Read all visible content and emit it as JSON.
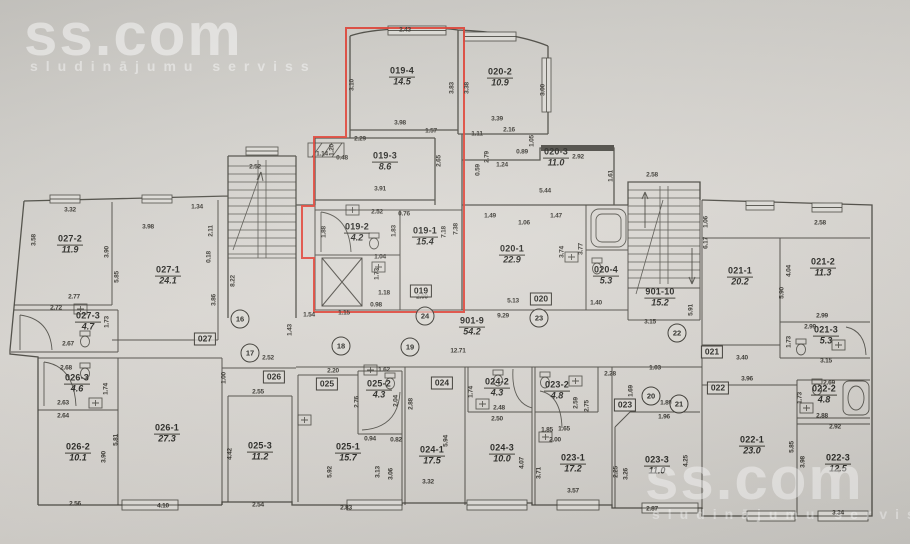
{
  "watermarks": {
    "logo": "ss.com",
    "tagline": "sludinājumu serviss"
  },
  "highlight": {
    "apartment": "019",
    "color": "#df3a2c"
  },
  "rooms": [
    {
      "name": "019-4",
      "area": "14.5",
      "x": 402,
      "y": 77
    },
    {
      "name": "020-2",
      "area": "10.9",
      "x": 500,
      "y": 78
    },
    {
      "name": "019-3",
      "area": "8.6",
      "x": 385,
      "y": 162
    },
    {
      "name": "020-3",
      "area": "11.0",
      "x": 556,
      "y": 158
    },
    {
      "name": "019-2",
      "area": "4.2",
      "x": 357,
      "y": 233
    },
    {
      "name": "019-1",
      "area": "15.4",
      "x": 425,
      "y": 237
    },
    {
      "name": "020-1",
      "area": "22.9",
      "x": 512,
      "y": 255
    },
    {
      "name": "020-4",
      "area": "5.3",
      "x": 606,
      "y": 276
    },
    {
      "name": "027-2",
      "area": "11.9",
      "x": 70,
      "y": 245
    },
    {
      "name": "027-1",
      "area": "24.1",
      "x": 168,
      "y": 276
    },
    {
      "name": "027-3",
      "area": "4.7",
      "x": 88,
      "y": 322
    },
    {
      "name": "901-10",
      "area": "15.2",
      "x": 660,
      "y": 298
    },
    {
      "name": "021-1",
      "area": "20.2",
      "x": 740,
      "y": 277
    },
    {
      "name": "021-2",
      "area": "11.3",
      "x": 823,
      "y": 268
    },
    {
      "name": "021-3",
      "area": "5.3",
      "x": 826,
      "y": 336
    },
    {
      "name": "901-9",
      "area": "54.2",
      "x": 472,
      "y": 327
    },
    {
      "name": "026-3",
      "area": "4.6",
      "x": 77,
      "y": 384
    },
    {
      "name": "026-2",
      "area": "10.1",
      "x": 78,
      "y": 453
    },
    {
      "name": "026-1",
      "area": "27.3",
      "x": 167,
      "y": 434
    },
    {
      "name": "025-3",
      "area": "11.2",
      "x": 260,
      "y": 452
    },
    {
      "name": "025-2",
      "area": "4.3",
      "x": 379,
      "y": 390
    },
    {
      "name": "025-1",
      "area": "15.7",
      "x": 348,
      "y": 453
    },
    {
      "name": "024-2",
      "area": "4.3",
      "x": 497,
      "y": 388
    },
    {
      "name": "024-1",
      "area": "17.5",
      "x": 432,
      "y": 456
    },
    {
      "name": "024-3",
      "area": "10.0",
      "x": 502,
      "y": 454
    },
    {
      "name": "023-2",
      "area": "4.8",
      "x": 557,
      "y": 391
    },
    {
      "name": "023-1",
      "area": "17.2",
      "x": 573,
      "y": 464
    },
    {
      "name": "023-3",
      "area": "11.0",
      "x": 657,
      "y": 466
    },
    {
      "name": "022-1",
      "area": "23.0",
      "x": 752,
      "y": 446
    },
    {
      "name": "022-2",
      "area": "4.8",
      "x": 824,
      "y": 395
    },
    {
      "name": "022-3",
      "area": "12.5",
      "x": 838,
      "y": 464
    }
  ],
  "badges": [
    {
      "label": "019",
      "x": 421,
      "y": 291
    },
    {
      "label": "020",
      "x": 541,
      "y": 299
    },
    {
      "label": "021",
      "x": 712,
      "y": 352
    },
    {
      "label": "022",
      "x": 718,
      "y": 388
    },
    {
      "label": "023",
      "x": 625,
      "y": 405
    },
    {
      "label": "024",
      "x": 442,
      "y": 383
    },
    {
      "label": "025",
      "x": 327,
      "y": 384
    },
    {
      "label": "026",
      "x": 274,
      "y": 377
    },
    {
      "label": "027",
      "x": 205,
      "y": 339
    }
  ],
  "markers": [
    {
      "label": "16",
      "x": 240,
      "y": 319
    },
    {
      "label": "17",
      "x": 250,
      "y": 353
    },
    {
      "label": "18",
      "x": 341,
      "y": 346
    },
    {
      "label": "19",
      "x": 410,
      "y": 347
    },
    {
      "label": "20",
      "x": 651,
      "y": 396
    },
    {
      "label": "21",
      "x": 679,
      "y": 404
    },
    {
      "label": "22",
      "x": 677,
      "y": 333
    },
    {
      "label": "23",
      "x": 539,
      "y": 318
    },
    {
      "label": "24",
      "x": 425,
      "y": 316
    }
  ],
  "dims": [
    {
      "t": "2.43",
      "x": 405,
      "y": 30
    },
    {
      "t": "3.10",
      "x": 352,
      "y": 85,
      "v": 1
    },
    {
      "t": "3.83",
      "x": 452,
      "y": 88,
      "v": 1
    },
    {
      "t": "3.98",
      "x": 400,
      "y": 123
    },
    {
      "t": "3.38",
      "x": 467,
      "y": 88,
      "v": 1
    },
    {
      "t": "3.00",
      "x": 543,
      "y": 90,
      "v": 1
    },
    {
      "t": "3.39",
      "x": 497,
      "y": 119
    },
    {
      "t": "1.57",
      "x": 431,
      "y": 131
    },
    {
      "t": "1.11",
      "x": 477,
      "y": 134
    },
    {
      "t": "2.29",
      "x": 360,
      "y": 139
    },
    {
      "t": "1.20",
      "x": 332,
      "y": 150,
      "v": 1
    },
    {
      "t": "1.14",
      "x": 322,
      "y": 154
    },
    {
      "t": "0.48",
      "x": 342,
      "y": 158
    },
    {
      "t": "2.16",
      "x": 509,
      "y": 130
    },
    {
      "t": "1.05",
      "x": 532,
      "y": 141,
      "v": 1
    },
    {
      "t": "0.89",
      "x": 522,
      "y": 152
    },
    {
      "t": "1.24",
      "x": 502,
      "y": 165
    },
    {
      "t": "2.92",
      "x": 578,
      "y": 157
    },
    {
      "t": "1.61",
      "x": 611,
      "y": 176,
      "v": 1
    },
    {
      "t": "2.58",
      "x": 652,
      "y": 175
    },
    {
      "t": "5.44",
      "x": 545,
      "y": 191
    },
    {
      "t": "2.65",
      "x": 439,
      "y": 161,
      "v": 1
    },
    {
      "t": "3.91",
      "x": 380,
      "y": 189
    },
    {
      "t": "2.79",
      "x": 487,
      "y": 157,
      "v": 1
    },
    {
      "t": "0.59",
      "x": 478,
      "y": 170,
      "v": 1
    },
    {
      "t": "1.49",
      "x": 490,
      "y": 216
    },
    {
      "t": "1.06",
      "x": 524,
      "y": 223
    },
    {
      "t": "1.47",
      "x": 556,
      "y": 216
    },
    {
      "t": "2.52",
      "x": 377,
      "y": 212
    },
    {
      "t": "0.76",
      "x": 404,
      "y": 214
    },
    {
      "t": "1.88",
      "x": 324,
      "y": 232,
      "v": 1
    },
    {
      "t": "1.83",
      "x": 394,
      "y": 231,
      "v": 1
    },
    {
      "t": "7.18",
      "x": 444,
      "y": 232,
      "v": 1
    },
    {
      "t": "7.38",
      "x": 456,
      "y": 229,
      "v": 1
    },
    {
      "t": "1.04",
      "x": 380,
      "y": 257
    },
    {
      "t": "1.73",
      "x": 377,
      "y": 274,
      "v": 1
    },
    {
      "t": "1.18",
      "x": 384,
      "y": 293
    },
    {
      "t": "2.09",
      "x": 422,
      "y": 297
    },
    {
      "t": "0.98",
      "x": 376,
      "y": 305
    },
    {
      "t": "5.13",
      "x": 513,
      "y": 301
    },
    {
      "t": "9.29",
      "x": 503,
      "y": 316
    },
    {
      "t": "3.74",
      "x": 562,
      "y": 252,
      "v": 1
    },
    {
      "t": "3.77",
      "x": 581,
      "y": 249,
      "v": 1
    },
    {
      "t": "1.40",
      "x": 596,
      "y": 303
    },
    {
      "t": "3.32",
      "x": 70,
      "y": 210
    },
    {
      "t": "3.58",
      "x": 34,
      "y": 240,
      "v": 1
    },
    {
      "t": "3.98",
      "x": 148,
      "y": 227
    },
    {
      "t": "1.34",
      "x": 197,
      "y": 207
    },
    {
      "t": "2.11",
      "x": 211,
      "y": 231,
      "v": 1
    },
    {
      "t": "3.90",
      "x": 107,
      "y": 252,
      "v": 1
    },
    {
      "t": "5.85",
      "x": 117,
      "y": 277,
      "v": 1
    },
    {
      "t": "0.18",
      "x": 209,
      "y": 257,
      "v": 1
    },
    {
      "t": "3.86",
      "x": 214,
      "y": 300,
      "v": 1
    },
    {
      "t": "2.77",
      "x": 74,
      "y": 297
    },
    {
      "t": "2.72",
      "x": 56,
      "y": 308
    },
    {
      "t": "2.67",
      "x": 68,
      "y": 344
    },
    {
      "t": "1.73",
      "x": 107,
      "y": 322,
      "v": 1
    },
    {
      "t": "2.52",
      "x": 255,
      "y": 167
    },
    {
      "t": "8.22",
      "x": 233,
      "y": 281,
      "v": 1
    },
    {
      "t": "2.52",
      "x": 268,
      "y": 358
    },
    {
      "t": "1.54",
      "x": 309,
      "y": 315
    },
    {
      "t": "1.15",
      "x": 344,
      "y": 313
    },
    {
      "t": "1.43",
      "x": 290,
      "y": 330,
      "v": 1
    },
    {
      "t": "12.71",
      "x": 458,
      "y": 351
    },
    {
      "t": "3.15",
      "x": 650,
      "y": 322
    },
    {
      "t": "5.91",
      "x": 691,
      "y": 310,
      "v": 1
    },
    {
      "t": "1.06",
      "x": 706,
      "y": 222,
      "v": 1
    },
    {
      "t": "6.17",
      "x": 706,
      "y": 243,
      "v": 1
    },
    {
      "t": "2.58",
      "x": 820,
      "y": 223
    },
    {
      "t": "4.04",
      "x": 789,
      "y": 271,
      "v": 1
    },
    {
      "t": "5.90",
      "x": 782,
      "y": 293,
      "v": 1
    },
    {
      "t": "2.99",
      "x": 822,
      "y": 316
    },
    {
      "t": "2.99",
      "x": 810,
      "y": 327
    },
    {
      "t": "1.73",
      "x": 789,
      "y": 342,
      "v": 1
    },
    {
      "t": "3.15",
      "x": 826,
      "y": 361
    },
    {
      "t": "3.40",
      "x": 742,
      "y": 358
    },
    {
      "t": "3.96",
      "x": 747,
      "y": 379
    },
    {
      "t": "2.69",
      "x": 829,
      "y": 383
    },
    {
      "t": "2.88",
      "x": 822,
      "y": 416
    },
    {
      "t": "1.73",
      "x": 800,
      "y": 398,
      "v": 1
    },
    {
      "t": "2.92",
      "x": 835,
      "y": 427
    },
    {
      "t": "5.85",
      "x": 792,
      "y": 447,
      "v": 1
    },
    {
      "t": "3.98",
      "x": 803,
      "y": 462,
      "v": 1
    },
    {
      "t": "3.34",
      "x": 838,
      "y": 513
    },
    {
      "t": "2.28",
      "x": 610,
      "y": 374
    },
    {
      "t": "1.03",
      "x": 655,
      "y": 368
    },
    {
      "t": "1.69",
      "x": 631,
      "y": 391,
      "v": 1
    },
    {
      "t": "1.89",
      "x": 666,
      "y": 403
    },
    {
      "t": "1.96",
      "x": 664,
      "y": 417
    },
    {
      "t": "2.25",
      "x": 616,
      "y": 472,
      "v": 1
    },
    {
      "t": "3.26",
      "x": 626,
      "y": 474,
      "v": 1
    },
    {
      "t": "4.25",
      "x": 686,
      "y": 461,
      "v": 1
    },
    {
      "t": "2.87",
      "x": 652,
      "y": 509
    },
    {
      "t": "3.57",
      "x": 573,
      "y": 491
    },
    {
      "t": "2.00",
      "x": 555,
      "y": 440
    },
    {
      "t": "1.85",
      "x": 547,
      "y": 430
    },
    {
      "t": "1.65",
      "x": 564,
      "y": 429
    },
    {
      "t": "2.59",
      "x": 576,
      "y": 403,
      "v": 1
    },
    {
      "t": "2.75",
      "x": 587,
      "y": 406,
      "v": 1
    },
    {
      "t": "1.74",
      "x": 471,
      "y": 392,
      "v": 1
    },
    {
      "t": "2.48",
      "x": 499,
      "y": 408
    },
    {
      "t": "2.50",
      "x": 497,
      "y": 419
    },
    {
      "t": "5.94",
      "x": 446,
      "y": 441,
      "v": 1
    },
    {
      "t": "2.88",
      "x": 411,
      "y": 404,
      "v": 1
    },
    {
      "t": "3.32",
      "x": 428,
      "y": 482
    },
    {
      "t": "4.07",
      "x": 522,
      "y": 463,
      "v": 1
    },
    {
      "t": "3.71",
      "x": 539,
      "y": 473,
      "v": 1
    },
    {
      "t": "2.20",
      "x": 333,
      "y": 371
    },
    {
      "t": "1.62",
      "x": 384,
      "y": 370
    },
    {
      "t": "2.76",
      "x": 357,
      "y": 402,
      "v": 1
    },
    {
      "t": "2.04",
      "x": 396,
      "y": 401,
      "v": 1
    },
    {
      "t": "0.94",
      "x": 370,
      "y": 439
    },
    {
      "t": "0.82",
      "x": 396,
      "y": 440
    },
    {
      "t": "5.92",
      "x": 330,
      "y": 472,
      "v": 1
    },
    {
      "t": "3.13",
      "x": 378,
      "y": 472,
      "v": 1
    },
    {
      "t": "3.06",
      "x": 391,
      "y": 474,
      "v": 1
    },
    {
      "t": "2.83",
      "x": 346,
      "y": 508
    },
    {
      "t": "2.54",
      "x": 258,
      "y": 505
    },
    {
      "t": "2.55",
      "x": 258,
      "y": 392
    },
    {
      "t": "4.42",
      "x": 230,
      "y": 454,
      "v": 1
    },
    {
      "t": "1.00",
      "x": 224,
      "y": 378,
      "v": 1
    },
    {
      "t": "2.68",
      "x": 66,
      "y": 368
    },
    {
      "t": "2.63",
      "x": 63,
      "y": 403
    },
    {
      "t": "1.74",
      "x": 106,
      "y": 389,
      "v": 1
    },
    {
      "t": "2.64",
      "x": 63,
      "y": 416
    },
    {
      "t": "3.90",
      "x": 104,
      "y": 457,
      "v": 1
    },
    {
      "t": "5.81",
      "x": 116,
      "y": 440,
      "v": 1
    },
    {
      "t": "2.56",
      "x": 75,
      "y": 504
    },
    {
      "t": "4.10",
      "x": 163,
      "y": 506
    }
  ]
}
